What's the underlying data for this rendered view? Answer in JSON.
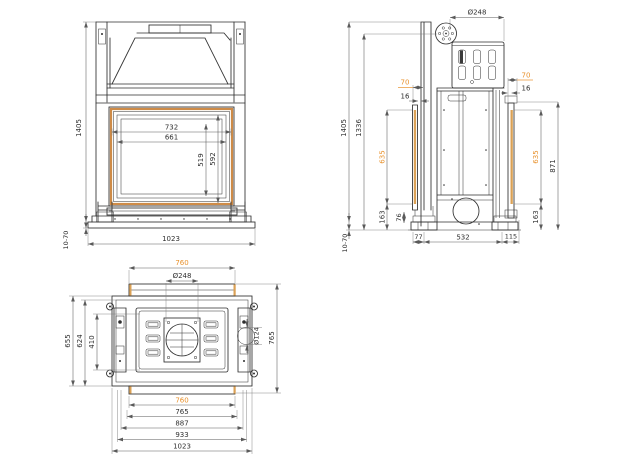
{
  "drawing": {
    "type": "technical-dimension-drawing",
    "subject": "fireplace-insert-three-view-drawing",
    "colors": {
      "accent": "#E8912C",
      "frame_highlight": "#CE8B47",
      "line": "#2e2e2e",
      "dim_line": "#5a5a5a",
      "background": "#ffffff"
    },
    "views": {
      "front": {
        "label": "front-view",
        "dims": {
          "overall_height": "1405",
          "foot_range": "10-70",
          "overall_width": "1023",
          "door_width": "732",
          "glass_width": "661",
          "glass_height": "519",
          "door_height": "592"
        }
      },
      "side": {
        "label": "side-view",
        "dims": {
          "flue_dia": "Ø248",
          "overall_height": "1405",
          "body_height": "1336",
          "foot_range": "10-70",
          "front_gap": "70",
          "front_thickness": "16",
          "front_frame_height": "635",
          "front_lower": "163",
          "foot_height": "76",
          "front_overhang": "77",
          "depth": "532",
          "rear_overhang": "115",
          "rear_gap": "70",
          "rear_thickness": "16",
          "rear_frame_height": "635",
          "rear_lower": "163",
          "rear_height": "871"
        }
      },
      "plan": {
        "label": "plan-view",
        "dims": {
          "frame_width_top": "760",
          "flue_dia": "Ø248",
          "depth_overall": "655",
          "depth_inner": "624",
          "depth_opening": "410",
          "outlet_dia": "Ø124",
          "depth_total": "765",
          "frame_width_bottom": "760",
          "frame_outer_width": "765",
          "body_width": "887",
          "base_width": "933",
          "overall_width": "1023"
        }
      }
    }
  }
}
